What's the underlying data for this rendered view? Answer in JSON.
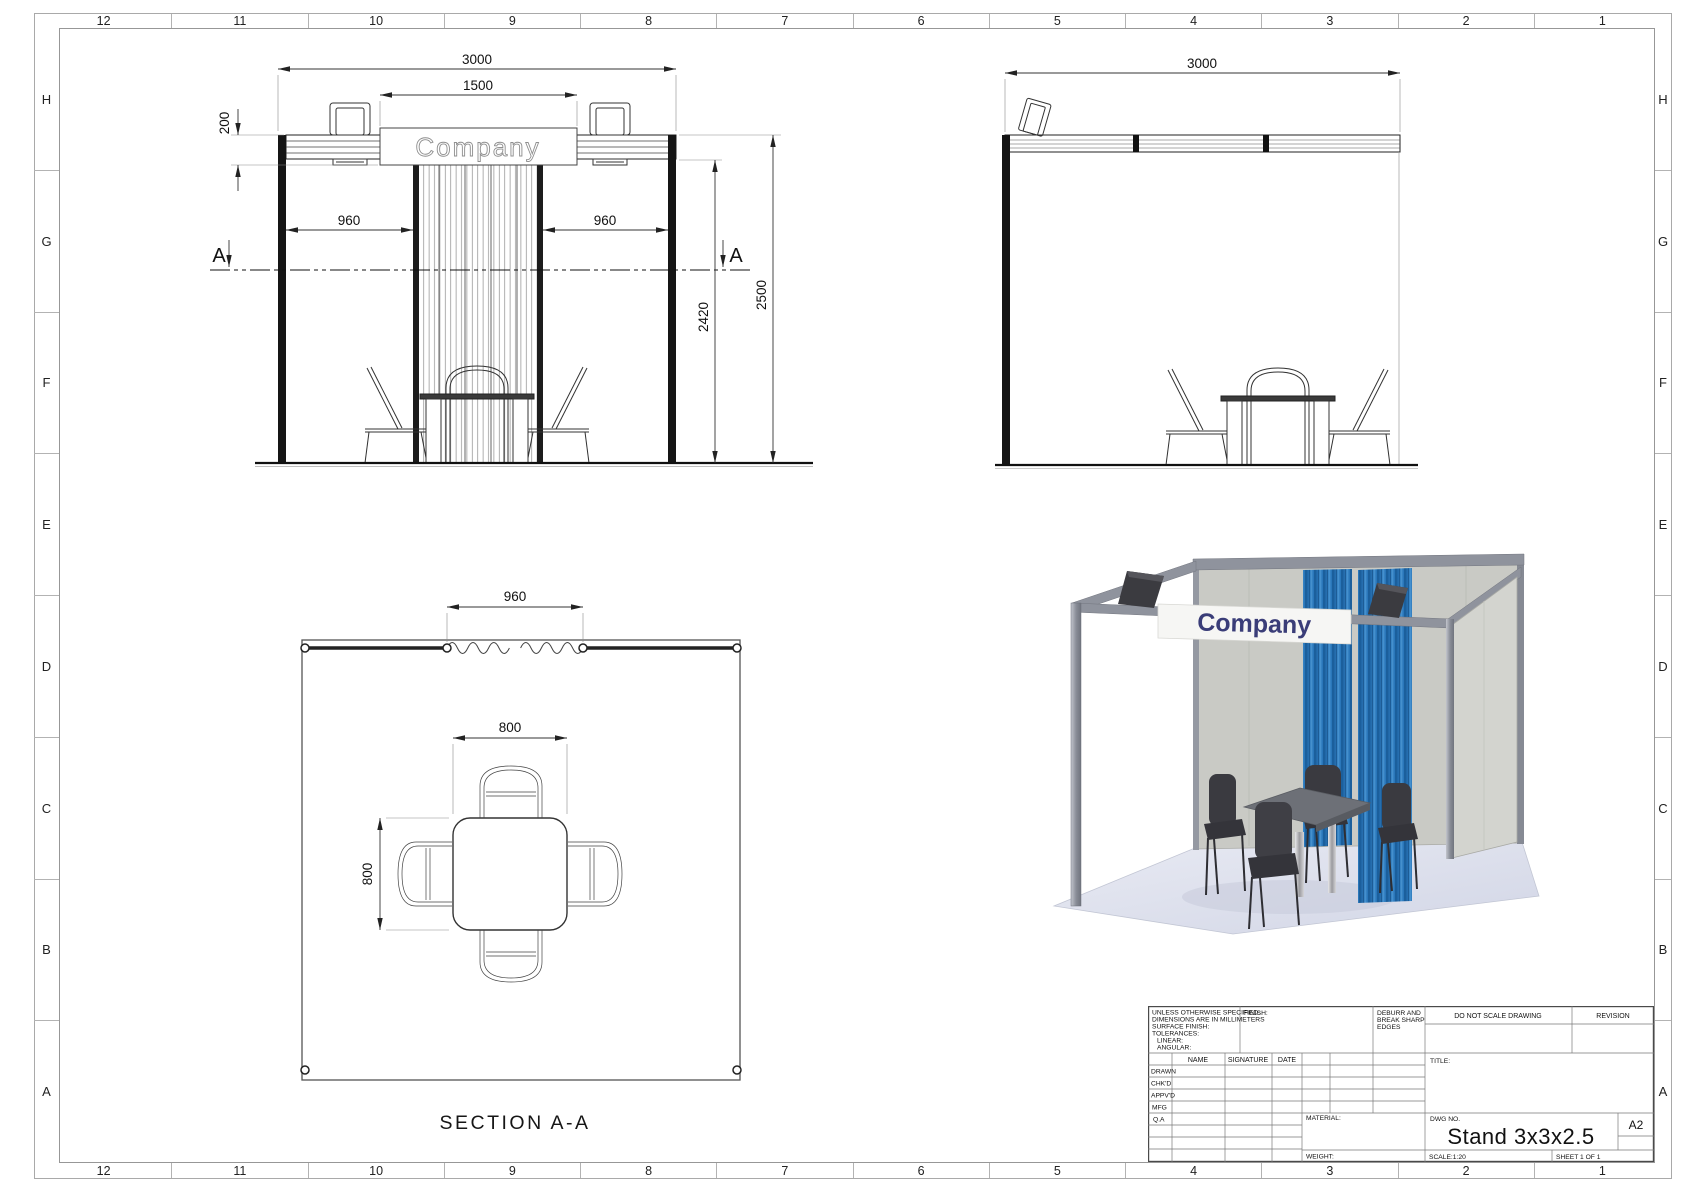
{
  "sheet": {
    "columns": [
      "12",
      "11",
      "10",
      "9",
      "8",
      "7",
      "6",
      "5",
      "4",
      "3",
      "2",
      "1"
    ],
    "rows": [
      "H",
      "G",
      "F",
      "E",
      "D",
      "C",
      "B",
      "A"
    ]
  },
  "front_view": {
    "sign_text": "Company",
    "section_letter": "A",
    "dim_width": "3000",
    "dim_sign_width": "1500",
    "dim_fascia_height": "200",
    "dim_left_bay": "960",
    "dim_right_bay": "960",
    "dim_inner_height": "2420",
    "dim_total_height": "2500"
  },
  "side_view": {
    "dim_width": "3000"
  },
  "plan_view": {
    "label": "SECTION A-A",
    "dim_curtain": "960",
    "dim_table_width": "800",
    "dim_table_depth": "800"
  },
  "render": {
    "banner_text": "Company",
    "colors": {
      "curtain_blue": "#2a77ba",
      "curtain_blue_dark": "#1b5f9c",
      "frame_gray": "#8f939d",
      "panel_gray": "#c9cac5",
      "floor_lavender": "#dde0ec",
      "chair_dark": "#3a3a40",
      "banner_navy": "#3a3d78"
    }
  },
  "title_block": {
    "spec_lines": [
      "UNLESS OTHERWISE SPECIFIED:",
      "DIMENSIONS ARE IN MILLIMETERS",
      "SURFACE FINISH:",
      "TOLERANCES:",
      "LINEAR:",
      "ANGULAR:"
    ],
    "finish_label": "FINISH:",
    "deburr_lines": [
      "DEBURR AND",
      "BREAK SHARP",
      "EDGES"
    ],
    "do_not_scale": "DO NOT SCALE DRAWING",
    "revision_label": "REVISION",
    "col_name": "NAME",
    "col_signature": "SIGNATURE",
    "col_date": "DATE",
    "row_drawn": "DRAWN",
    "row_chkd": "CHK'D",
    "row_appvd": "APPV'D",
    "row_mfg": "MFG",
    "row_qa": "Q.A",
    "title_label": "TITLE:",
    "material_label": "MATERIAL:",
    "weight_label": "WEIGHT:",
    "dwg_label": "DWG NO.",
    "dwg_value": "Stand 3x3x2.5",
    "paper_size": "A2",
    "scale_label": "SCALE:1:20",
    "sheet_label": "SHEET 1 OF 1"
  }
}
